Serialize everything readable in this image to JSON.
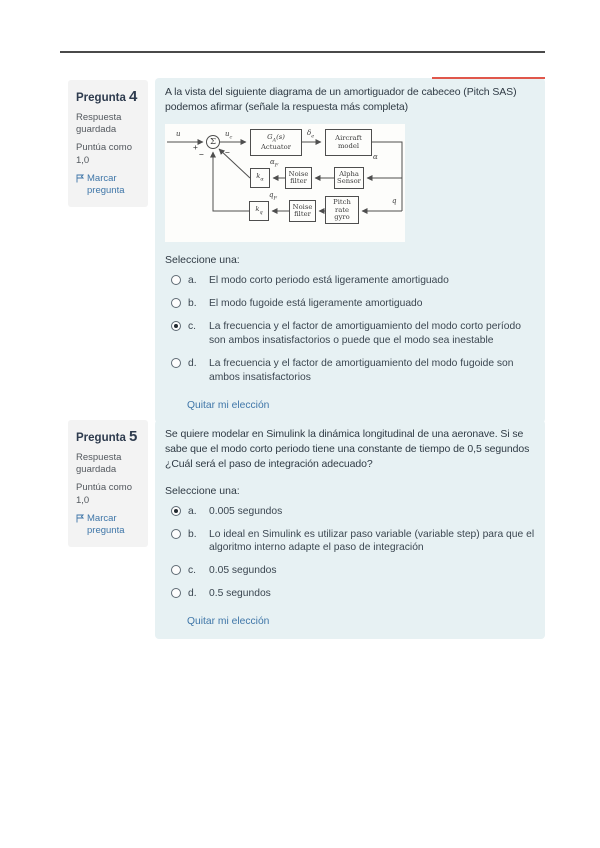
{
  "questions": [
    {
      "label": "Pregunta",
      "number": "4",
      "status": "Respuesta guardada",
      "grade": "Puntúa como 1,0",
      "flag": "Marcar pregunta",
      "text": "A la vista del siguiente diagrama de un amortiguador de cabeceo (Pitch SAS) podemos afirmar (señale la respuesta más completa)",
      "prompt": "Seleccione una:",
      "options": [
        {
          "letter": "a.",
          "text": "El modo corto periodo está ligeramente amortiguado",
          "selected": false
        },
        {
          "letter": "b.",
          "text": "El modo fugoide está ligeramente amortiguado",
          "selected": false
        },
        {
          "letter": "c.",
          "text": "La frecuencia y el factor de amortiguamiento del modo corto período son ambos insatisfactorios o puede que el modo sea inestable",
          "selected": true
        },
        {
          "letter": "d.",
          "text": "La frecuencia y el factor de amortiguamiento del modo fugoide son ambos insatisfactorios",
          "selected": false
        }
      ],
      "clear": "Quitar mi elección"
    },
    {
      "label": "Pregunta",
      "number": "5",
      "status": "Respuesta guardada",
      "grade": "Puntúa como 1,0",
      "flag": "Marcar pregunta",
      "text": "Se quiere modelar en Simulink la dinámica longitudinal de una aeronave. Si se sabe que el modo corto periodo tiene una constante de tiempo de 0,5 segundos ¿Cuál será el paso de integración adecuado?",
      "prompt": "Seleccione una:",
      "options": [
        {
          "letter": "a.",
          "text": "0.005 segundos",
          "selected": true
        },
        {
          "letter": "b.",
          "text": "Lo ideal en Simulink es utilizar paso variable (variable step) para que el algoritmo interno adapte el paso de integración",
          "selected": false
        },
        {
          "letter": "c.",
          "text": "0.05 segundos",
          "selected": false
        },
        {
          "letter": "d.",
          "text": "0.5 segundos",
          "selected": false
        }
      ],
      "clear": "Quitar mi elección"
    }
  ],
  "diagram": {
    "input": "u",
    "plus": "+",
    "minus_vert": "−",
    "minus_diag": "−",
    "sigma": "Σ",
    "sum_out": {
      "base": "u",
      "sub": "c"
    },
    "actuator": {
      "g": "G",
      "g_sub": "A",
      "g_rest": "(s)",
      "name": "Actuator"
    },
    "delta": {
      "base": "δ",
      "sub": "e"
    },
    "aircraft": {
      "line1": "Aircraft",
      "line2": "model"
    },
    "alpha": "α",
    "alpha_sensor": {
      "line1": "Alpha",
      "line2": "Sensor"
    },
    "noise_filter": {
      "line1": "Noise",
      "line2": "filter"
    },
    "alpha_f": {
      "base": "α",
      "sub": "F"
    },
    "k_alpha": {
      "base": "k",
      "sub": "α"
    },
    "q": "q",
    "pitch_gyro": {
      "line1": "Pitch",
      "line2": "rate",
      "line3": "gyro"
    },
    "q_f": {
      "base": "q",
      "sub": "F"
    },
    "k_q": {
      "base": "k",
      "sub": "q"
    }
  },
  "colors": {
    "content_bg": "#e7f1f3",
    "info_bg": "#f3f3f3",
    "accent_red": "#e0574b",
    "link": "#3f76a8"
  }
}
